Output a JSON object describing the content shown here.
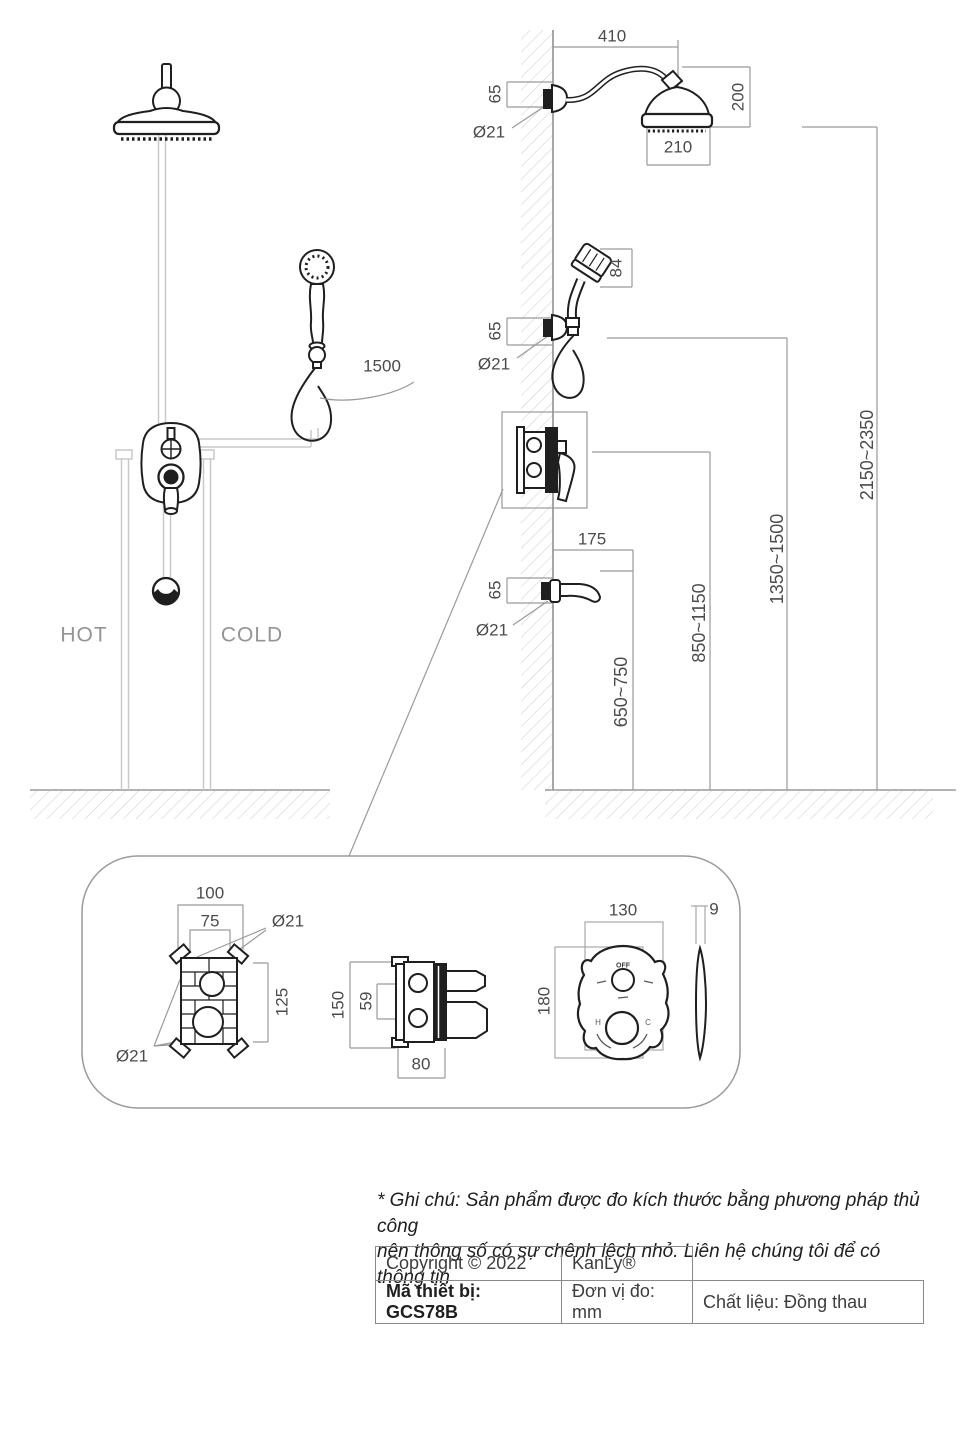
{
  "schematic": {
    "hot": "HOT",
    "cold": "COLD",
    "hose_length": "1500"
  },
  "dims": {
    "arm_reach": "410",
    "arm_height": "65",
    "arm_dia": "Ø21",
    "head_drop": "200",
    "head_dia": "210",
    "hand_head_len": "84",
    "hand_height": "65",
    "hand_dia": "Ø21",
    "spout_reach": "175",
    "spout_height": "65",
    "spout_dia": "Ø21",
    "range_spout": "650~750",
    "range_valve": "850~1150",
    "range_hand": "1350~1500",
    "range_head": "2150~2350"
  },
  "details": {
    "front": {
      "outer_w": "100",
      "inner_w": "75",
      "dia_top": "Ø21",
      "inner_h": "125",
      "dia_bottom": "Ø21"
    },
    "side": {
      "outer_h": "150",
      "port_gap": "59",
      "depth": "80"
    },
    "plate": {
      "w": "130",
      "h": "180",
      "thickness": "9",
      "off_label": "OFF",
      "hot_label": "H",
      "cold_label": "C"
    }
  },
  "note": {
    "line1": "* Ghi chú: Sản phẩm được đo kích thước bằng phương pháp thủ công",
    "line2": "nên thông số có sự chênh lệch nhỏ. Liên hệ chúng tôi để có thông tin"
  },
  "info_table": {
    "copyright": "Copyright © 2022",
    "brand": "KanLy®",
    "model": "Mã thiết bị: GCS78B",
    "unit": "Đơn vị đo: mm",
    "material": "Chất liệu: Đồng thau"
  }
}
